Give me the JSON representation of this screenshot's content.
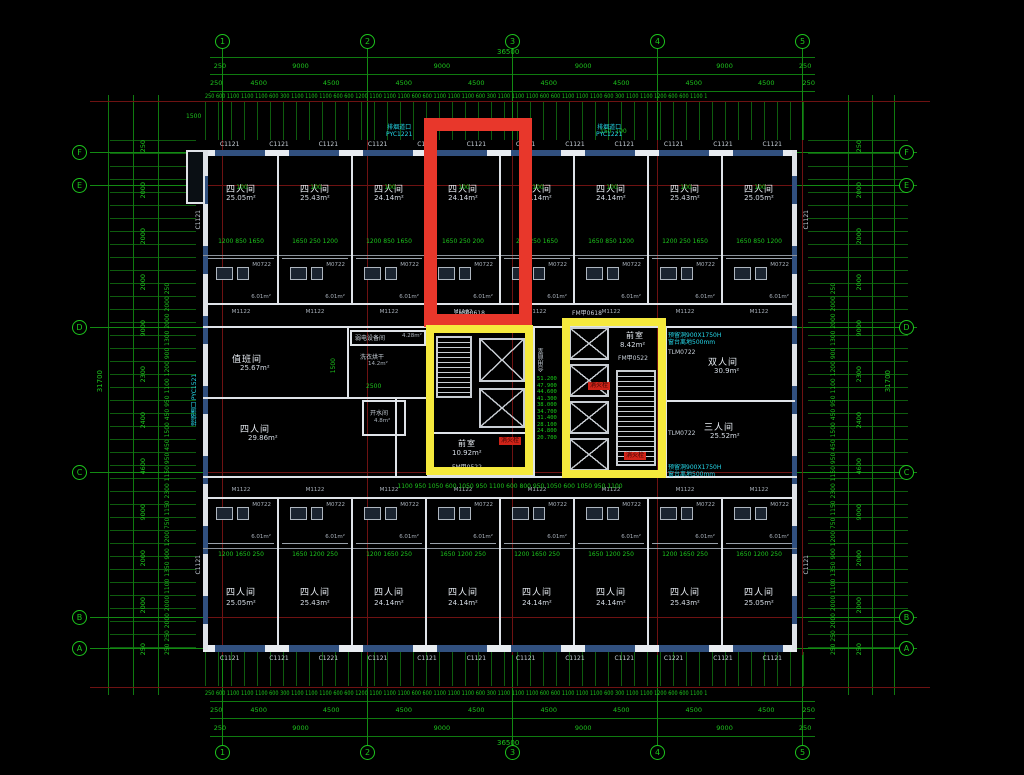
{
  "grid": {
    "cols": [
      "1",
      "2",
      "3",
      "4",
      "5"
    ],
    "rows": [
      "F",
      "E",
      "D",
      "C",
      "B",
      "A"
    ]
  },
  "dims": {
    "overall_w": "36500",
    "overall_h": "31700",
    "row9000": [
      "250",
      "9000",
      "9000",
      "9000",
      "9000",
      "250"
    ],
    "row4500": [
      "250",
      "4500",
      "4500",
      "4500",
      "4500",
      "4500",
      "4500",
      "4500",
      "4500",
      "250"
    ],
    "fine": "250 600 1100 1100 1100 600 300 1100 1100 1100 600 600 1200 1100 1100 1100 600 600 1100 1100 1100 600 300 1100 1100 1100 600 600 1100 1100 1100 600 300 1100 1100 1200 600 600 1100 1100 1100 600 500 1100 1100 1100 600 250",
    "side_segments": [
      "250",
      "2000",
      "2000",
      "2000",
      "9000",
      "2300",
      "2400",
      "4600",
      "9000",
      "2000",
      "2000",
      "250"
    ],
    "side_fine": "250 250 2000 2000 1100 1350 900 1200 750 1150 2300 1150 950 450 1500 450 950 1100 1200 900 1300 2000 2000 250",
    "corner": "1500",
    "mark100": "100",
    "mark150": "150  100"
  },
  "windows": {
    "top": [
      "C1121",
      "C1121",
      "C1121",
      "C1121",
      "C1121",
      "C1121",
      "C1121",
      "C1121",
      "C1121",
      "C1121",
      "C1121",
      "C1121"
    ],
    "bottom": [
      "C1121",
      "C1121",
      "C1221",
      "C1121",
      "C1121",
      "C1121",
      "C1121",
      "C1121",
      "C1121",
      "C1221",
      "C1121",
      "C1121"
    ],
    "side": "C1121"
  },
  "rooms_top": [
    {
      "name": "四人间",
      "area": "25.05m²",
      "dims": "1200 850 1650"
    },
    {
      "name": "四人间",
      "area": "25.43m²",
      "dims": "1650 250 1200"
    },
    {
      "name": "四人间",
      "area": "24.14m²",
      "dims": "1200 850 1650"
    },
    {
      "name": "四人间",
      "area": "24.14m²",
      "dims": "1650 250 200"
    },
    {
      "name": "四人间",
      "area": "24.14m²",
      "dims": "200 250 1650"
    },
    {
      "name": "四人间",
      "area": "24.14m²",
      "dims": "1650 850 1200"
    },
    {
      "name": "四人间",
      "area": "25.43m²",
      "dims": "1200 250 1650"
    },
    {
      "name": "四人间",
      "area": "25.05m²",
      "dims": "1650 850 1200"
    }
  ],
  "rooms_bottom": [
    {
      "name": "四人间",
      "area": "25.05m²",
      "dims": "1200 1650 250"
    },
    {
      "name": "四人间",
      "area": "25.43m²",
      "dims": "1650 1200 250"
    },
    {
      "name": "四人间",
      "area": "24.14m²",
      "dims": "1200 1650 250"
    },
    {
      "name": "四人间",
      "area": "24.14m²",
      "dims": "1650 1200 250"
    },
    {
      "name": "四人间",
      "area": "24.14m²",
      "dims": "1200 1650 250"
    },
    {
      "name": "四人间",
      "area": "24.14m²",
      "dims": "1650 1200 250"
    },
    {
      "name": "四人间",
      "area": "25.43m²",
      "dims": "1200 1650 250"
    },
    {
      "name": "四人间",
      "area": "25.05m²",
      "dims": "1650 1200 250"
    }
  ],
  "mid": {
    "duty": {
      "name": "值班间",
      "area": "25.67m²"
    },
    "laundry": {
      "name": "洗衣烘干",
      "area": "14.2m²",
      "dim": "2500",
      "dim2": "1500"
    },
    "lowvolt": {
      "name": "弱电设备间",
      "area": "4.28m²"
    },
    "four": {
      "name": "四人间",
      "area": "29.86m²"
    },
    "boiler": {
      "name": "开水间",
      "area": "4.8m²"
    },
    "double": {
      "name": "双人间",
      "area": "30.9m²"
    },
    "triple": {
      "name": "三人间",
      "area": "25.52m²"
    },
    "front_left": {
      "name": "前室",
      "area": "10.92m²",
      "door": "FM甲0522"
    },
    "front_right": {
      "name": "前室",
      "area": "8.42m²",
      "door": "FM甲0522"
    },
    "shared": "合用前室",
    "hydrant": "消火栓",
    "corridor_door": "FM甲0618",
    "corridor_dims": "1100 950 1050 600 1050 950 1100 600 800 950 1050 600 1050 950 1100",
    "elevations": [
      "51.200",
      "47.900",
      "44.600",
      "41.300",
      "38.000",
      "34.700",
      "31.400",
      "28.100",
      "24.800",
      "20.700"
    ]
  },
  "ann": {
    "bath": "6.01m²",
    "bath_door": "M0722",
    "entry_door": "M1122",
    "tlm": "TLM0722",
    "smoke": "排烟道口",
    "smoke_tag_top": "PYC1221",
    "smoke_left": "排烟道口 PYC1521",
    "hole": "预留洞900X1750H",
    "sill": "窗台离地500mm"
  }
}
